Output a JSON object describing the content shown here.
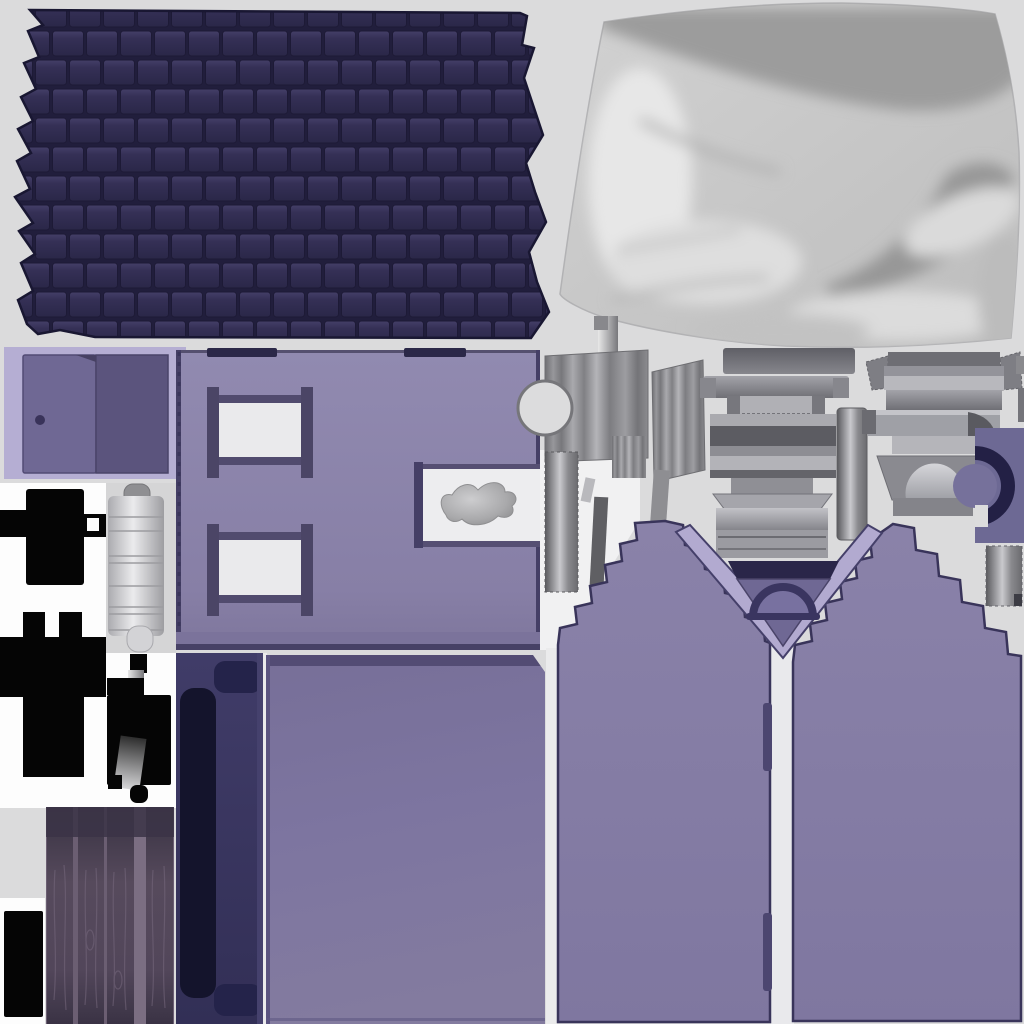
{
  "atlas": {
    "kind": "texture-atlas",
    "background": "#dbdbdc",
    "islands": [
      "roof-shingle-texture",
      "fabric-texture",
      "door-panel-island",
      "wall-panel",
      "window-frame-upper",
      "window-frame-lower",
      "wall-notch-cloth",
      "hardware-cluster-left",
      "hardware-cluster-middle",
      "hardware-cluster-right",
      "arch-trim-island",
      "striped-trim-bar",
      "hinge-mask-top",
      "hinge-mask-bottom",
      "door-hinge-barrel",
      "hinge-hardware-lower",
      "navy-door-panel",
      "floor-panel",
      "wood-plank-texture",
      "mask-rectangle",
      "gable-wall-left",
      "gable-wall-right",
      "gable-vent-vee"
    ]
  },
  "palette": {
    "background": "#dbdbdc",
    "white_island": "#fdfdfd",
    "cool_gray_island": "#d5d5d6",
    "roof_gap": "#211e3c",
    "roof_tile": "#343054",
    "roof_outline": "#191732",
    "fabric_base": "#c9c9c9",
    "fabric_shadow": "#9b9b9b",
    "fabric_highlight": "#eaeaea",
    "door_bg": "#b5aed3",
    "door_face": "#6f6894",
    "door_side": "#5b547d",
    "knob": "#39335a",
    "wall": "#8b83aa",
    "trim_dark": "#453f66",
    "glass": "#eaeaec",
    "notch_white": "#ededef",
    "cloth_gray": "#a9a9ab",
    "floor": "#7b739d",
    "navy_panel": "#383463",
    "navy_inner": "#14142c",
    "navy_tab": "#24234a",
    "gable": "#857da6",
    "gable_outline": "#3a355c",
    "vee_band": "#b2aad0",
    "vee_navy": "#2a2649",
    "vee_triangle": "#6f6894",
    "arch_stroke": "#3a3560",
    "plank_base": "#4d4356",
    "plank_dark": "#382f41",
    "plank_strip": "#7b6e82",
    "mask_black": "#050505",
    "slate_square": "#6d6994",
    "arc_navy": "#232045",
    "metal_light": "#e7e7e9",
    "metal_mid": "#9a9a9e",
    "metal_dark": "#5f5f63"
  }
}
